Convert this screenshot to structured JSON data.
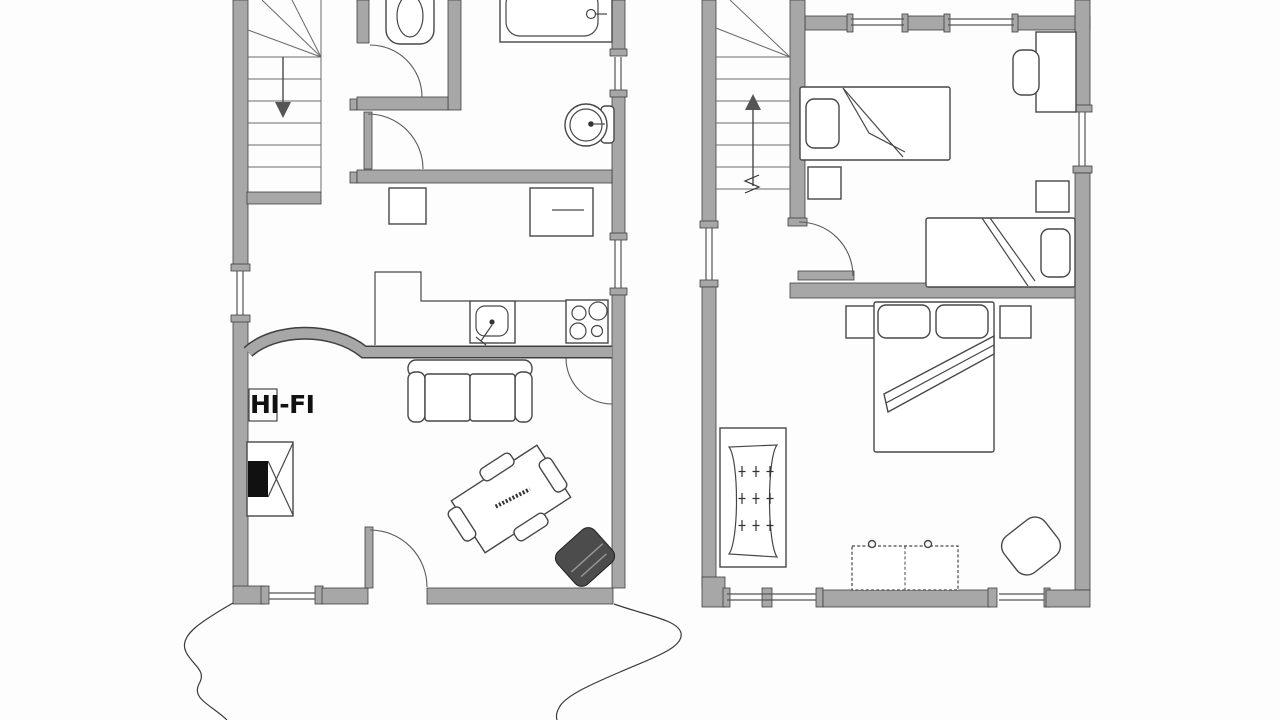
{
  "labels": {
    "hifi": "HI-FI"
  },
  "colors": {
    "background": "#fdfdfd",
    "wall_fill": "#a7a7a7",
    "wall_outline": "#3f3f3f",
    "thin_line": "#555555",
    "furniture_line": "#474747",
    "dark_furniture": "#4c4c4c",
    "text": "#111111"
  },
  "plans": [
    {
      "id": "ground-floor",
      "position": "left",
      "rooms": [
        "stairwell",
        "wc",
        "bathroom",
        "kitchen-hall",
        "living-room"
      ],
      "stairs": {
        "direction": "down",
        "treads": 7
      },
      "fixtures": [
        "toilet",
        "bathtub",
        "round-washbasin",
        "kitchen-sink",
        "stove-4-burners",
        "kitchen-counter",
        "hall-cabinet",
        "dresser"
      ],
      "furniture": [
        "two-seat-sofa",
        "dining-table-with-4-chairs",
        "fireplace",
        "hifi-unit",
        "armchair"
      ],
      "doors": 5,
      "windows": 4
    },
    {
      "id": "upper-floor",
      "position": "right",
      "rooms": [
        "stair-landing",
        "bedroom-two-single-beds",
        "bedroom-double-bed"
      ],
      "stairs": {
        "direction": "up",
        "treads": 7
      },
      "furniture": [
        "single-bed-1",
        "single-bed-2",
        "double-bed",
        "desk",
        "desk-chair",
        "nightstand-x4",
        "radiator-shelf",
        "chest-of-drawers",
        "stool"
      ],
      "doors": 1,
      "windows": 6
    }
  ]
}
